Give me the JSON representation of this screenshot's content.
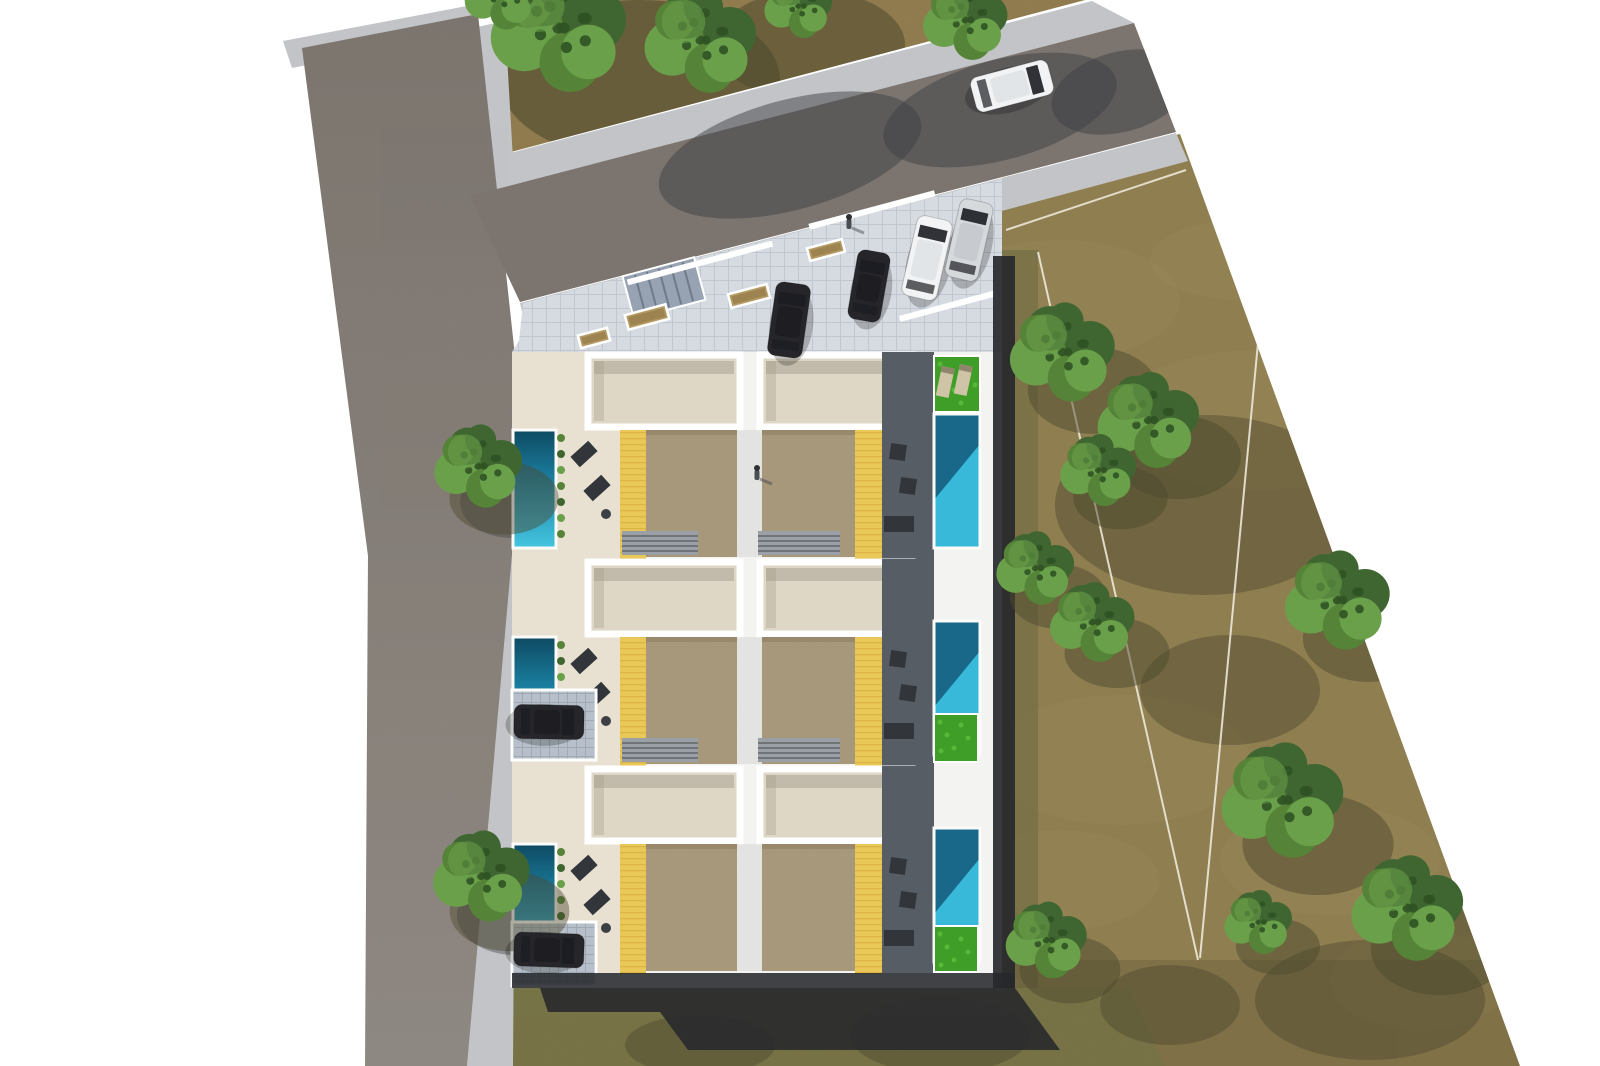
{
  "scene": {
    "description": "aerial-render-residential-development",
    "canvas": {
      "w": 1600,
      "h": 1066
    },
    "palette": {
      "bg": "#ffffff",
      "road": "#89817a",
      "road_light": "#9d968f",
      "sidewalk": "#d6d8db",
      "paver": "#e0e4ea",
      "paver_line": "#c9cfd8",
      "dirt_parcel": "#a38c58",
      "field": "#a3905c",
      "field_light": "#b5a26c",
      "scrub": "#82804f",
      "grass_strip": "#6e6b43",
      "tree_dark": "#3f6630",
      "tree_mid": "#558438",
      "tree_light": "#6ba04b",
      "tree_speck": "#2f5223",
      "tree_shadow": "#4e4a2e",
      "road_shadow": "#3d4046",
      "bldg_white": "#f3f3f1",
      "wall_white": "#ffffff",
      "terrace": "#ded7c6",
      "terrace_shadow": "#a59e8d",
      "courtyard": "#e8e1d1",
      "roof": "#b4a384",
      "roof_edge": "#9c8c6e",
      "deck_yellow": "#eac858",
      "deck_line": "#cfa638",
      "patio_dark": "#575d64",
      "pool_deep": "#0e4a62",
      "pool_mid": "#1b82a4",
      "pool_bright": "#44c5e0",
      "pool_right": "#38b9da",
      "pool_shadow": "#14597a",
      "lawn": "#3f9e27",
      "lawn_light": "#57b83a",
      "planter": "#b49a62",
      "grate": "#97a3b2",
      "steps": "#9aa0a5",
      "step_line": "#4a4e52",
      "tile": "#b7c0ca",
      "tile_line": "#9fa9b5",
      "shadow": "#27282c",
      "car_dark": "#26262a",
      "car_dark_roof": "#1e1e22",
      "car_white": "#f2f3f4",
      "car_white_roof": "#e2e5e7",
      "car_silver": "#d6d9dc",
      "car_silver_roof": "#c7cbcf",
      "car_glass": "#1b1d22",
      "furniture": "#32363b",
      "lounger_beige": "#cfc4a6",
      "survey_line": "#f3efe2"
    },
    "houses": {
      "count": 6,
      "rows": [
        {
          "y": 352
        },
        {
          "y": 559
        },
        {
          "y": 766
        }
      ],
      "row_height": 207,
      "pools_left": 3,
      "pools_right": 3
    },
    "trees": {
      "parcel": [
        {
          "x": 558,
          "y": 28,
          "r": 80
        },
        {
          "x": 700,
          "y": 40,
          "r": 66
        },
        {
          "x": 500,
          "y": -4,
          "r": 42
        },
        {
          "x": 798,
          "y": 6,
          "r": 40
        }
      ],
      "street": [
        {
          "x": 478,
          "y": 466,
          "r": 52
        },
        {
          "x": 481,
          "y": 876,
          "r": 57
        }
      ],
      "field": [
        {
          "x": 965,
          "y": 20,
          "r": 50
        },
        {
          "x": 1062,
          "y": 352,
          "r": 62
        },
        {
          "x": 1148,
          "y": 420,
          "r": 60
        },
        {
          "x": 1098,
          "y": 470,
          "r": 45
        },
        {
          "x": 1035,
          "y": 568,
          "r": 46
        },
        {
          "x": 1092,
          "y": 622,
          "r": 50
        },
        {
          "x": 1337,
          "y": 600,
          "r": 62
        },
        {
          "x": 1282,
          "y": 800,
          "r": 72
        },
        {
          "x": 1258,
          "y": 922,
          "r": 40
        },
        {
          "x": 1407,
          "y": 908,
          "r": 66
        },
        {
          "x": 1046,
          "y": 940,
          "r": 48
        }
      ]
    },
    "field_shadow_blobs": [
      {
        "cx": 1205,
        "cy": 505,
        "rx": 150,
        "ry": 90
      },
      {
        "cx": 1230,
        "cy": 690,
        "rx": 90,
        "ry": 55
      },
      {
        "cx": 1370,
        "cy": 1000,
        "rx": 115,
        "ry": 60
      },
      {
        "cx": 940,
        "cy": 1035,
        "rx": 90,
        "ry": 38
      },
      {
        "cx": 700,
        "cy": 1045,
        "rx": 75,
        "ry": 30
      },
      {
        "cx": 1170,
        "cy": 1005,
        "rx": 70,
        "ry": 40
      }
    ],
    "survey_lines": [
      {
        "x1": 1038,
        "y1": 252,
        "x2": 1198,
        "y2": 960
      },
      {
        "x1": 1266,
        "y1": 258,
        "x2": 1200,
        "y2": 958
      },
      {
        "x1": 1006,
        "y1": 230,
        "x2": 1186,
        "y2": 170
      }
    ],
    "cars": [
      {
        "name": "road-car",
        "cx": 1012,
        "cy": 86,
        "len": 80,
        "wid": 36,
        "angle": 75,
        "color": "white"
      },
      {
        "name": "parked-car-white",
        "cx": 927,
        "cy": 258,
        "len": 82,
        "wid": 36,
        "angle": 13,
        "color": "white"
      },
      {
        "name": "parked-car-silver",
        "cx": 969,
        "cy": 240,
        "len": 80,
        "wid": 34,
        "angle": 13,
        "color": "silver"
      },
      {
        "name": "plaza-car-dark-1",
        "cx": 789,
        "cy": 320,
        "len": 74,
        "wid": 35,
        "angle": 8,
        "color": "dark"
      },
      {
        "name": "plaza-car-dark-2",
        "cx": 869,
        "cy": 286,
        "len": 70,
        "wid": 33,
        "angle": 10,
        "color": "dark"
      },
      {
        "name": "driveway-car-1",
        "cx": 549,
        "cy": 722,
        "len": 70,
        "wid": 34,
        "angle": 91,
        "color": "dark"
      },
      {
        "name": "driveway-car-2",
        "cx": 549,
        "cy": 950,
        "len": 70,
        "wid": 34,
        "angle": 92,
        "color": "dark"
      }
    ],
    "people": [
      {
        "x": 849,
        "y": 219
      },
      {
        "x": 757,
        "y": 470
      }
    ],
    "lawns": [
      {
        "x": 934,
        "y": 356,
        "w": 46,
        "h": 56,
        "loungers": true
      },
      {
        "x": 934,
        "y": 714,
        "w": 44,
        "h": 48,
        "loungers": false
      },
      {
        "x": 934,
        "y": 926,
        "w": 44,
        "h": 46,
        "loungers": false
      }
    ],
    "planters": [
      {
        "cx": 647,
        "cy": 317,
        "w": 42,
        "h": 15
      },
      {
        "cx": 749,
        "cy": 296,
        "w": 40,
        "h": 14
      },
      {
        "cx": 826,
        "cy": 250,
        "w": 36,
        "h": 13
      },
      {
        "cx": 594,
        "cy": 338,
        "w": 30,
        "h": 13
      }
    ],
    "grate": {
      "cx": 664,
      "cy": 288,
      "w": 74,
      "h": 44,
      "angle": -15
    },
    "driveway_pads": [
      {
        "x": 512,
        "y": 690,
        "w": 84,
        "h": 70
      },
      {
        "x": 512,
        "y": 922,
        "w": 84,
        "h": 64
      }
    ]
  }
}
